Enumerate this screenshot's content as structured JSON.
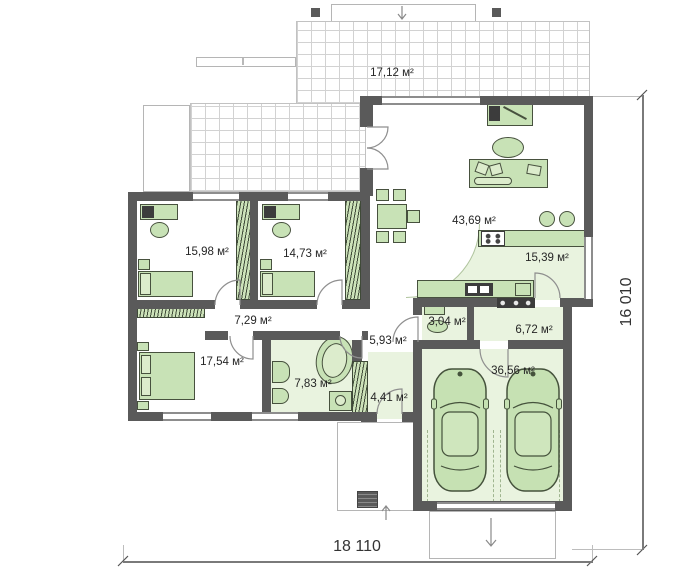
{
  "plan": {
    "type": "architectural-floor-plan",
    "rooms": [
      {
        "id": "terrace",
        "area": "17,12 м²"
      },
      {
        "id": "bedroom-1",
        "area": "15,98 м²"
      },
      {
        "id": "bedroom-2",
        "area": "14,73 м²"
      },
      {
        "id": "living-room",
        "area": "43,69 м²"
      },
      {
        "id": "kitchen",
        "area": "15,39 м²"
      },
      {
        "id": "hallway",
        "area": "7,29 м²"
      },
      {
        "id": "bedroom-3",
        "area": "17,54 м²"
      },
      {
        "id": "bathroom",
        "area": "7,83 м²"
      },
      {
        "id": "entrance-hall",
        "area": "5,93 м²"
      },
      {
        "id": "wc",
        "area": "3,04 м²"
      },
      {
        "id": "utility-room",
        "area": "6,72 м²"
      },
      {
        "id": "closet",
        "area": "4,41 м²"
      },
      {
        "id": "garage",
        "area": "36,56 м²"
      }
    ],
    "dimensions": {
      "width": "18 110",
      "height": "16 010"
    },
    "colors": {
      "wall": "#5a5a5a",
      "furniture_fill": "#c8e2b6",
      "furniture_border": "#47513e",
      "floor_green": "#e9f3df"
    }
  }
}
